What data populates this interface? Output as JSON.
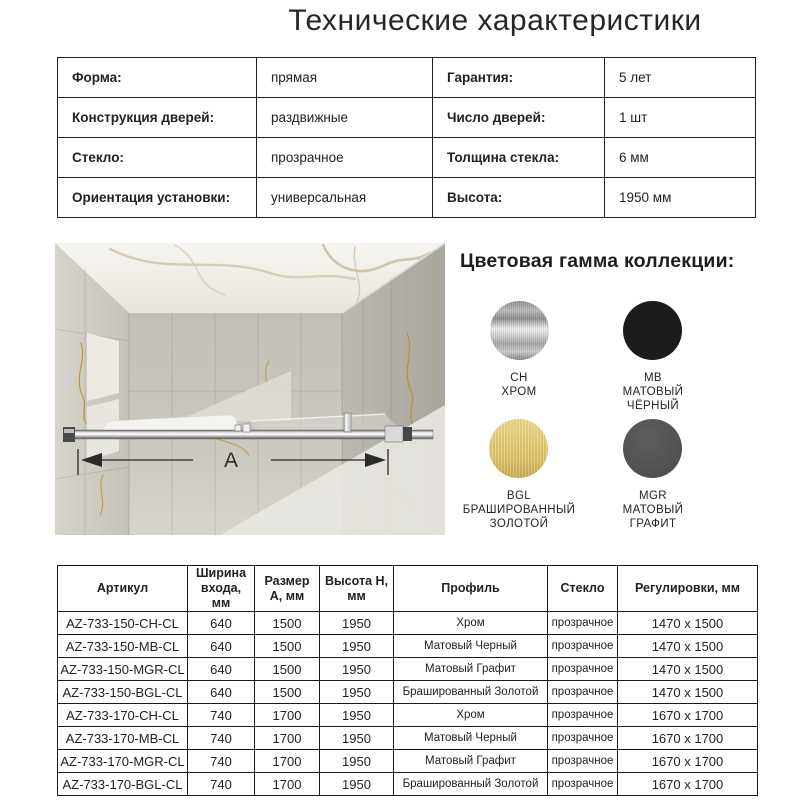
{
  "title": "Технические характеристики",
  "spec_table": {
    "rows": [
      {
        "l_label": "Форма:",
        "l_value": "прямая",
        "r_label": "Гарантия:",
        "r_value": "5 лет"
      },
      {
        "l_label": "Конструкция дверей:",
        "l_value": "раздвижные",
        "r_label": "Число дверей:",
        "r_value": "1 шт"
      },
      {
        "l_label": "Стекло:",
        "l_value": "прозрачное",
        "r_label": "Толщина стекла:",
        "r_value": "6 мм"
      },
      {
        "l_label": "Ориентация установки:",
        "l_value": "универсальная",
        "r_label": "Высота:",
        "r_value": "1950 мм"
      }
    ]
  },
  "product_image": {
    "description": "top view render of sliding shower door in marble bathroom",
    "dimension_label": "А"
  },
  "colors_section": {
    "title": "Цветовая гамма коллекции:",
    "swatches": [
      {
        "code": "CH",
        "name_lines": [
          "ХРОМ"
        ],
        "color": "#c9c9c9"
      },
      {
        "code": "MB",
        "name_lines": [
          "МАТОВЫЙ",
          "ЧЁРНЫЙ"
        ],
        "color": "#1c1c1c"
      },
      {
        "code": "BGL",
        "name_lines": [
          "БРАШИРОВАННЫЙ",
          "ЗОЛОТОЙ"
        ],
        "color": "#e0c670"
      },
      {
        "code": "MGR",
        "name_lines": [
          "МАТОВЫЙ",
          "ГРАФИТ"
        ],
        "color": "#525252"
      }
    ]
  },
  "products_table": {
    "headers": [
      "Артикул",
      "Ширина входа, мм",
      "Размер А, мм",
      "Высота Н, мм",
      "Профиль",
      "Стекло",
      "Регулировки, мм"
    ],
    "rows": [
      [
        "AZ-733-150-CH-CL",
        "640",
        "1500",
        "1950",
        "Хром",
        "прозрачное",
        "1470 x 1500"
      ],
      [
        "AZ-733-150-MB-CL",
        "640",
        "1500",
        "1950",
        "Матовый Черный",
        "прозрачное",
        "1470 x 1500"
      ],
      [
        "AZ-733-150-MGR-CL",
        "640",
        "1500",
        "1950",
        "Матовый Графит",
        "прозрачное",
        "1470 x 1500"
      ],
      [
        "AZ-733-150-BGL-CL",
        "640",
        "1500",
        "1950",
        "Брашированный Золотой",
        "прозрачное",
        "1470 x 1500"
      ],
      [
        "AZ-733-170-CH-CL",
        "740",
        "1700",
        "1950",
        "Хром",
        "прозрачное",
        "1670 x 1700"
      ],
      [
        "AZ-733-170-MB-CL",
        "740",
        "1700",
        "1950",
        "Матовый Черный",
        "прозрачное",
        "1670 x 1700"
      ],
      [
        "AZ-733-170-MGR-CL",
        "740",
        "1700",
        "1950",
        "Матовый Графит",
        "прозрачное",
        "1670 x 1700"
      ],
      [
        "AZ-733-170-BGL-CL",
        "740",
        "1700",
        "1950",
        "Брашированный Золотой",
        "прозрачное",
        "1670 x 1700"
      ]
    ]
  }
}
